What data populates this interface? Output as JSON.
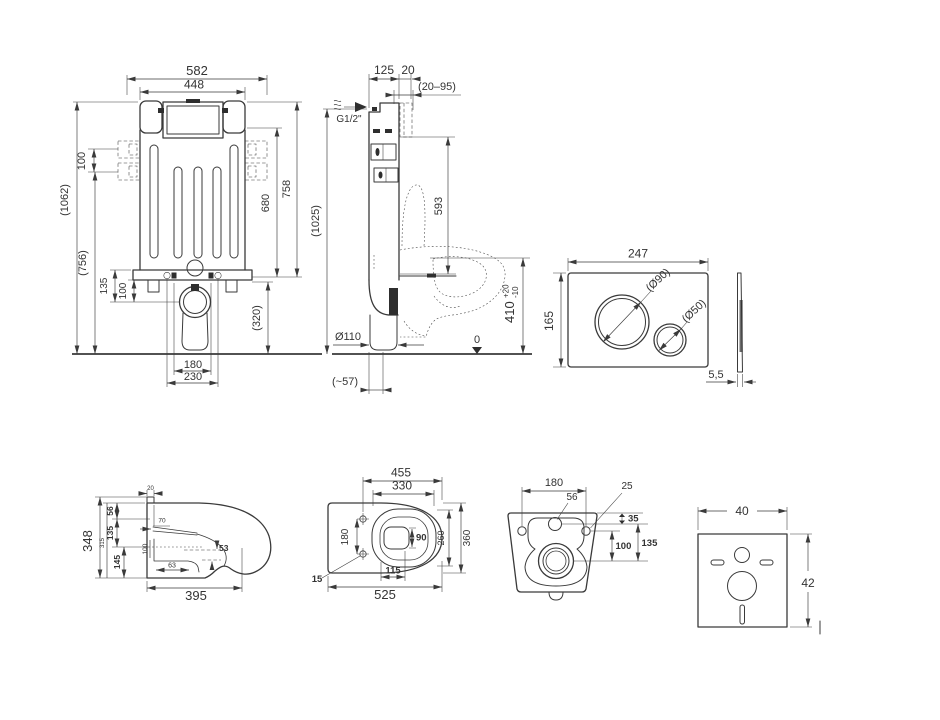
{
  "front": {
    "w582": "582",
    "w448": "448",
    "h100": "100",
    "h1062": "(1062)",
    "h756": "(756)",
    "h758": "758",
    "h680": "680",
    "h320": "(320)",
    "h135": "135",
    "h100b": "100",
    "w180": "180",
    "w230": "230"
  },
  "side": {
    "w125": "125",
    "w20": "20",
    "r2095": "(20–95)",
    "thread": "G1/2\"",
    "h1025": "(1025)",
    "h593": "593",
    "h410": "410",
    "tp": "+20",
    "tm": "-10",
    "d110": "Ø110",
    "w57": "(~57)",
    "zero": "0"
  },
  "plate": {
    "w247": "247",
    "h165": "165",
    "d90": "(Ø90)",
    "d50": "(Ø50)",
    "t55": "5,5"
  },
  "bside": {
    "h348": "348",
    "h315": "315",
    "h56": "56",
    "h135": "135",
    "h145": "145",
    "w20": "20",
    "w70": "70",
    "h100": "100",
    "w63": "63",
    "h53": "53",
    "w395": "395"
  },
  "btop": {
    "w455": "455",
    "w330": "330",
    "w525": "525",
    "h180": "180",
    "h360": "360",
    "h260": "260",
    "w115": "115",
    "h90": "90",
    "n15": "15"
  },
  "bback": {
    "w180": "180",
    "n56": "56",
    "n25": "25",
    "h35": "35",
    "h100": "100",
    "h135": "135"
  },
  "pad": {
    "w40": "40",
    "h42": "42"
  }
}
